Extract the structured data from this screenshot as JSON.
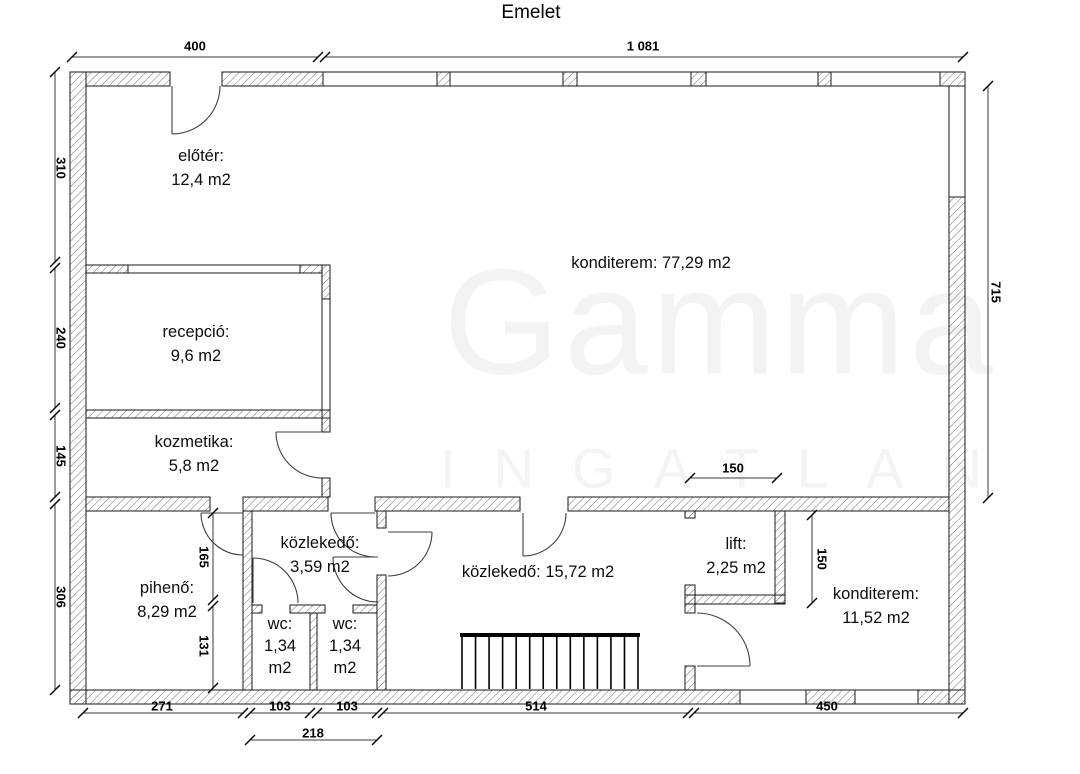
{
  "title": "Emelet",
  "watermark": {
    "word": "Gamma",
    "subtitle": "INGATLAN"
  },
  "rooms": {
    "eloter": {
      "name": "előtér:",
      "area": "12,4 m2"
    },
    "recepcio": {
      "name": "recepció:",
      "area": "9,6 m2"
    },
    "kozmetika": {
      "name": "kozmetika:",
      "area": "5,8 m2"
    },
    "konditerem_nagy": {
      "label": "konditerem: 77,29 m2"
    },
    "piheno": {
      "name": "pihenő:",
      "area": "8,29 m2"
    },
    "kozlekedo_kis": {
      "name": "közlekedő:",
      "area": "3,59 m2"
    },
    "wc_bal": {
      "name": "wc:",
      "line2": "1,34",
      "line3": "m2"
    },
    "wc_jobb": {
      "name": "wc:",
      "line2": "1,34",
      "line3": "m2"
    },
    "kozlekedo_nagy": {
      "label": "közlekedő: 15,72 m2"
    },
    "lift": {
      "name": "lift:",
      "area": "2,25 m2"
    },
    "konditerem_kis": {
      "name": "konditerem:",
      "area": "11,52 m2"
    }
  },
  "dimensions": {
    "top": {
      "left": "400",
      "right": "1 081"
    },
    "left": {
      "d1": "310",
      "d2": "240",
      "d3": "145",
      "d4": "306"
    },
    "right": {
      "d1": "715"
    },
    "bottom": {
      "d1": "271",
      "d2": "103",
      "d3": "103",
      "d4": "514",
      "d5": "450",
      "sub": "218"
    },
    "interior": {
      "v165": "165",
      "v131": "131",
      "h150": "150",
      "v150": "150"
    }
  }
}
